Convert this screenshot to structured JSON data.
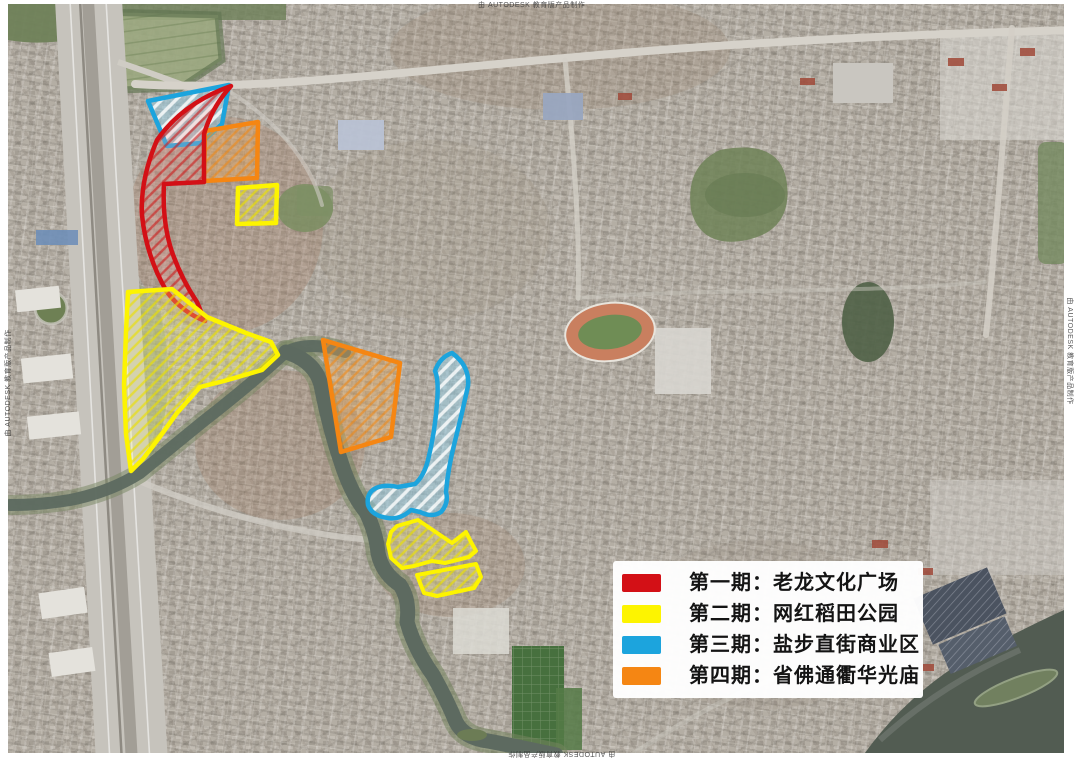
{
  "legend": {
    "items": [
      {
        "label": "第一期：老龙文化广场",
        "color": "#d31016"
      },
      {
        "label": "第二期：网红稻田公园",
        "color": "#fdf400"
      },
      {
        "label": "第三期：盐步直街商业区",
        "color": "#1ca4dd"
      },
      {
        "label": "第四期：省佛通衢华光庙",
        "color": "#f58613"
      }
    ]
  },
  "watermark": {
    "text": "由 AUTODESK 教育版产品制作"
  }
}
